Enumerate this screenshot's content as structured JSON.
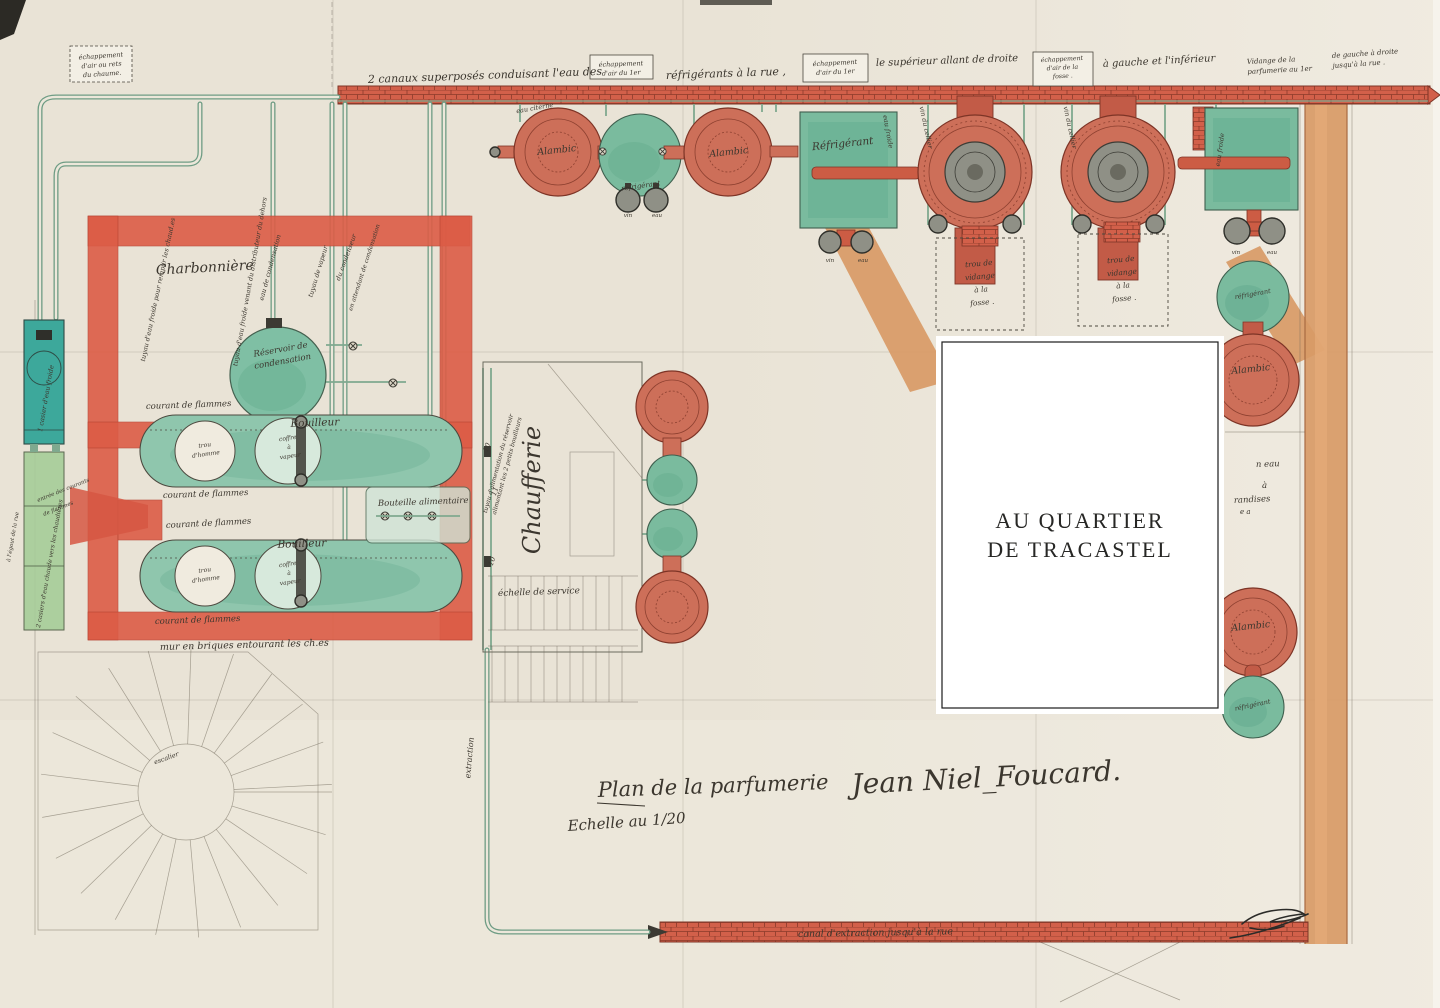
{
  "palette": {
    "paper": "#e9e3d6",
    "wall_red": "#dc5c46",
    "brick": "#d2604a",
    "brick_line": "#8a3a2a",
    "orange_wall": "#d89a66",
    "vessel_teal": "#7abb9e",
    "vessel_red": "#cd6f59",
    "tank_teal": "#3da89b",
    "tank_green": "#a6cd98",
    "pipe_green": "#6e9c84",
    "ink": "#3b362e",
    "red_ink": "#b5483b"
  },
  "overlay": {
    "line1": "AU QUARTIER",
    "line2": "DE TRACASTEL"
  },
  "title": {
    "prefix": "Plan de la parfumerie",
    "name": "Jean Niel_Foucard.",
    "scale": "Echelle au 1/20"
  },
  "labels": [
    {
      "n": "note-echap-chaume",
      "L": [
        "échappement",
        "d'air ou rets",
        "du chaume."
      ],
      "x": 101,
      "y": 58,
      "s": 6.5,
      "r": -4,
      "lh": 9
    },
    {
      "n": "note-canaux-1",
      "t": "2 canaux superposés conduisant l'eau des",
      "x": 368,
      "y": 83,
      "s": 11,
      "r": -2,
      "a": "start"
    },
    {
      "n": "note-canaux-2",
      "t": "réfrigérants à la rue ,",
      "x": 666,
      "y": 79,
      "s": 11,
      "r": -2,
      "a": "start"
    },
    {
      "n": "note-echap-1er-a",
      "L": [
        "échappement",
        "d'air du 1er"
      ],
      "x": 621,
      "y": 66,
      "s": 6.5,
      "r": -2,
      "lh": 9
    },
    {
      "n": "note-echap-1er-b",
      "L": [
        "échappement",
        "d'air du 1er"
      ],
      "x": 835,
      "y": 65,
      "s": 6.5,
      "r": -3,
      "lh": 9
    },
    {
      "n": "note-superieur",
      "t": "le supérieur allant de droite",
      "x": 876,
      "y": 66,
      "s": 10,
      "r": -2,
      "a": "start"
    },
    {
      "n": "note-echap-fosse",
      "L": [
        "échappement",
        "d'air de la",
        "fosse ."
      ],
      "x": 1062,
      "y": 61,
      "s": 6.2,
      "r": -3,
      "lh": 8.5
    },
    {
      "n": "note-gauche-inferieur",
      "t": "à gauche et l'inférieur",
      "x": 1103,
      "y": 67,
      "s": 10,
      "r": -3,
      "a": "start"
    },
    {
      "n": "note-vidange-1",
      "L": [
        "Vidange de la",
        "parfumerie au 1er"
      ],
      "x": 1247,
      "y": 64,
      "s": 7,
      "r": -3,
      "a": "start",
      "lh": 10
    },
    {
      "n": "note-vidange-2",
      "L": [
        "de gauche à droite",
        "jusqu'à la rue ."
      ],
      "x": 1332,
      "y": 58,
      "s": 7,
      "r": -4,
      "a": "start",
      "lh": 10
    },
    {
      "n": "pipe-eau-froide-remplir",
      "t": "tuyau d'eau froide pour remplir les chaud.es",
      "x": 160,
      "y": 290,
      "s": 6.5,
      "r": -78
    },
    {
      "n": "pipe-eau-distributeur",
      "t": "tuyau d'eau froide venant du distributeur du dehors",
      "x": 252,
      "y": 282,
      "s": 6.5,
      "r": -80
    },
    {
      "n": "pipe-eau-cond",
      "t": "eau de condensation",
      "x": 272,
      "y": 268,
      "s": 6.5,
      "r": -75
    },
    {
      "n": "pipe-vapeur",
      "t": "tuyau de vapeur",
      "x": 320,
      "y": 272,
      "s": 6.5,
      "r": -73
    },
    {
      "n": "pipe-condenseur",
      "t": "du condenseur",
      "x": 348,
      "y": 258,
      "s": 6.5,
      "r": -70
    },
    {
      "n": "pipe-attente-cond",
      "t": "en attendant de condensation",
      "x": 366,
      "y": 268,
      "s": 6,
      "r": -72
    },
    {
      "n": "reservoir-label",
      "L": [
        "Réservoir de",
        "condensation"
      ],
      "x": 281,
      "y": 352,
      "s": 8.5,
      "r": -10,
      "lh": 12
    },
    {
      "n": "room-charbonniere",
      "t": "Charbonnière",
      "x": 205,
      "y": 272,
      "s": 14,
      "r": -3
    },
    {
      "n": "boiler1-label",
      "t": "Bouilleur",
      "x": 315,
      "y": 426,
      "s": 10.5,
      "r": -2
    },
    {
      "n": "boiler2-label",
      "t": "Bouilleur",
      "x": 302,
      "y": 547,
      "s": 10.5,
      "r": -2
    },
    {
      "n": "boiler1-trou",
      "L": [
        "trou",
        "d'homme"
      ],
      "x": 205,
      "y": 447,
      "s": 6,
      "r": -8,
      "lh": 9
    },
    {
      "n": "boiler1-coffre",
      "L": [
        "coffre",
        "à",
        "vapeur"
      ],
      "x": 288,
      "y": 440,
      "s": 6,
      "r": -8,
      "lh": 9
    },
    {
      "n": "boiler2-trou",
      "L": [
        "trou",
        "d'homme"
      ],
      "x": 205,
      "y": 572,
      "s": 6,
      "r": -8,
      "lh": 9
    },
    {
      "n": "boiler2-coffre",
      "L": [
        "coffre",
        "à",
        "vapeur"
      ],
      "x": 288,
      "y": 566,
      "s": 6,
      "r": -8,
      "lh": 9
    },
    {
      "n": "flammes-1",
      "t": "courant de flammes",
      "x": 146,
      "y": 409,
      "s": 8.5,
      "r": -2,
      "a": "start"
    },
    {
      "n": "flammes-2",
      "t": "courant de flammes",
      "x": 163,
      "y": 498,
      "s": 8.5,
      "r": -2,
      "a": "start"
    },
    {
      "n": "flammes-3",
      "t": "courant de flammes",
      "x": 166,
      "y": 528,
      "s": 8.5,
      "r": -3,
      "a": "start"
    },
    {
      "n": "flammes-4",
      "t": "courant de flammes",
      "x": 155,
      "y": 624,
      "s": 8.5,
      "r": -2,
      "a": "start"
    },
    {
      "n": "flammes-entree-1",
      "t": "entrée des courants",
      "x": 38,
      "y": 502,
      "s": 5.5,
      "r": -22,
      "a": "start"
    },
    {
      "n": "flammes-entree-2",
      "t": "de flammes",
      "x": 44,
      "y": 516,
      "s": 5.5,
      "r": -22,
      "a": "start"
    },
    {
      "n": "mur-briques",
      "t": "mur en briques entourant les ch.es",
      "x": 160,
      "y": 650,
      "s": 9.5,
      "r": -1.5,
      "a": "start",
      "c": "#b5483b"
    },
    {
      "n": "bouteille-alim",
      "t": "Bouteille alimentaire",
      "x": 378,
      "y": 506,
      "s": 8.5,
      "r": -2,
      "a": "start"
    },
    {
      "n": "pipe-alimentation",
      "L": [
        "tuyau d'alimentation du réservoir",
        "alimentant les 2 petits bouilleurs"
      ],
      "x": 500,
      "y": 464,
      "s": 6,
      "r": -75,
      "lh": 9
    },
    {
      "n": "num-10a",
      "t": "10",
      "x": 489,
      "y": 448,
      "s": 7,
      "r": -70
    },
    {
      "n": "num-11",
      "t": "11",
      "x": 497,
      "y": 492,
      "s": 7,
      "r": -70
    },
    {
      "n": "num-10b",
      "t": "10",
      "x": 494,
      "y": 562,
      "s": 7,
      "r": -70
    },
    {
      "n": "room-chaufferie",
      "t": "Chaufferie",
      "x": 540,
      "y": 490,
      "s": 24,
      "r": -90
    },
    {
      "n": "echelle-service",
      "t": "échelle de service",
      "x": 498,
      "y": 596,
      "s": 9,
      "r": -2,
      "a": "start"
    },
    {
      "n": "pipe-extraction",
      "t": "extraction",
      "x": 472,
      "y": 758,
      "s": 8,
      "r": -85
    },
    {
      "n": "escalier",
      "t": "escalier",
      "x": 167,
      "y": 760,
      "s": 6.5,
      "r": -20
    },
    {
      "n": "eau-citerne",
      "t": "eau citerne",
      "x": 535,
      "y": 110,
      "s": 6.5,
      "r": -10
    },
    {
      "n": "alambic-row1-a",
      "t": "Alambic",
      "x": 557,
      "y": 153,
      "s": 9.5,
      "r": -6
    },
    {
      "n": "refrig-row1",
      "t": "réfrigérant",
      "x": 641,
      "y": 188,
      "s": 7,
      "r": -8
    },
    {
      "n": "vin-row1",
      "t": "vin",
      "x": 628,
      "y": 217,
      "s": 5.5
    },
    {
      "n": "eau-row1",
      "t": "eau",
      "x": 657,
      "y": 217,
      "s": 5.5
    },
    {
      "n": "alambic-row1-b",
      "t": "Alambic",
      "x": 729,
      "y": 155,
      "s": 9.5,
      "r": -6
    },
    {
      "n": "refrig-sq1",
      "t": "Réfrigérant",
      "x": 843,
      "y": 147,
      "s": 10.5,
      "r": -6
    },
    {
      "n": "refrig-sq1-eau",
      "t": "eau froide",
      "x": 886,
      "y": 132,
      "s": 6.5,
      "r": 80
    },
    {
      "n": "vin-sq1",
      "t": "vin",
      "x": 830,
      "y": 262,
      "s": 5.5
    },
    {
      "n": "eau-sq1",
      "t": "eau",
      "x": 863,
      "y": 262,
      "s": 5.5
    },
    {
      "n": "pipe-vin-cellier-a",
      "t": "vin du cellier",
      "x": 924,
      "y": 128,
      "s": 6.5,
      "r": 78
    },
    {
      "n": "pipe-vin-cellier-b",
      "t": "vin du cellier",
      "x": 1068,
      "y": 128,
      "s": 6.5,
      "r": 78
    },
    {
      "n": "refrig-sq2-eau",
      "t": "eau froide",
      "x": 1222,
      "y": 150,
      "s": 6.5,
      "r": -82
    },
    {
      "n": "vin-sq2",
      "t": "vin",
      "x": 1236,
      "y": 254,
      "s": 5.5
    },
    {
      "n": "eau-sq2",
      "t": "eau",
      "x": 1272,
      "y": 254,
      "s": 5.5
    },
    {
      "n": "fosse-box-1",
      "L": [
        "trou de",
        "vidange",
        "à la",
        "fosse ."
      ],
      "x": 979,
      "y": 266,
      "s": 7.5,
      "r": -5,
      "lh": 13
    },
    {
      "n": "fosse-box-2",
      "L": [
        "trou de",
        "vidange",
        "à la",
        "fosse ."
      ],
      "x": 1121,
      "y": 262,
      "s": 7.5,
      "r": -5,
      "lh": 13
    },
    {
      "n": "refrig-right-top",
      "t": "réfrigérant",
      "x": 1253,
      "y": 296,
      "s": 6.5,
      "r": -10
    },
    {
      "n": "alambic-right-top",
      "t": "Alambic",
      "x": 1251,
      "y": 372,
      "s": 9.5,
      "r": -6
    },
    {
      "n": "frag-eau",
      "t": "n eau",
      "x": 1256,
      "y": 467,
      "s": 8.5,
      "r": -2,
      "a": "start"
    },
    {
      "n": "frag-a",
      "t": "à",
      "x": 1262,
      "y": 488,
      "s": 8.5,
      "a": "start"
    },
    {
      "n": "frag-marchandises",
      "t": "randises",
      "x": 1234,
      "y": 503,
      "s": 8.5,
      "r": -3,
      "a": "start"
    },
    {
      "n": "frag-ea",
      "t": "e a",
      "x": 1240,
      "y": 514,
      "s": 7,
      "a": "start"
    },
    {
      "n": "alambic-right-bottom",
      "t": "Alambic",
      "x": 1251,
      "y": 629,
      "s": 9.5,
      "r": -6
    },
    {
      "n": "refrig-right-bottom",
      "t": "réfrigérant",
      "x": 1253,
      "y": 707,
      "s": 6.5,
      "r": -12
    },
    {
      "n": "canal-extraction",
      "t": "canal d'extraction jusqu'à la rue",
      "x": 798,
      "y": 937,
      "s": 9.5,
      "r": -1,
      "a": "start"
    },
    {
      "n": "tank-eau-froide",
      "t": "1 casier d'eau froide",
      "x": 42,
      "y": 432,
      "s": 6.5,
      "r": -80,
      "a": "start"
    },
    {
      "n": "tank-eau-chaude",
      "t": "2 casiers d'eau chaude vers les chaudières",
      "x": 40,
      "y": 628,
      "s": 6,
      "r": -80,
      "a": "start"
    },
    {
      "n": "egout",
      "t": "à l'égout de la rue",
      "x": 10,
      "y": 562,
      "s": 5.5,
      "r": -80,
      "a": "start"
    }
  ]
}
